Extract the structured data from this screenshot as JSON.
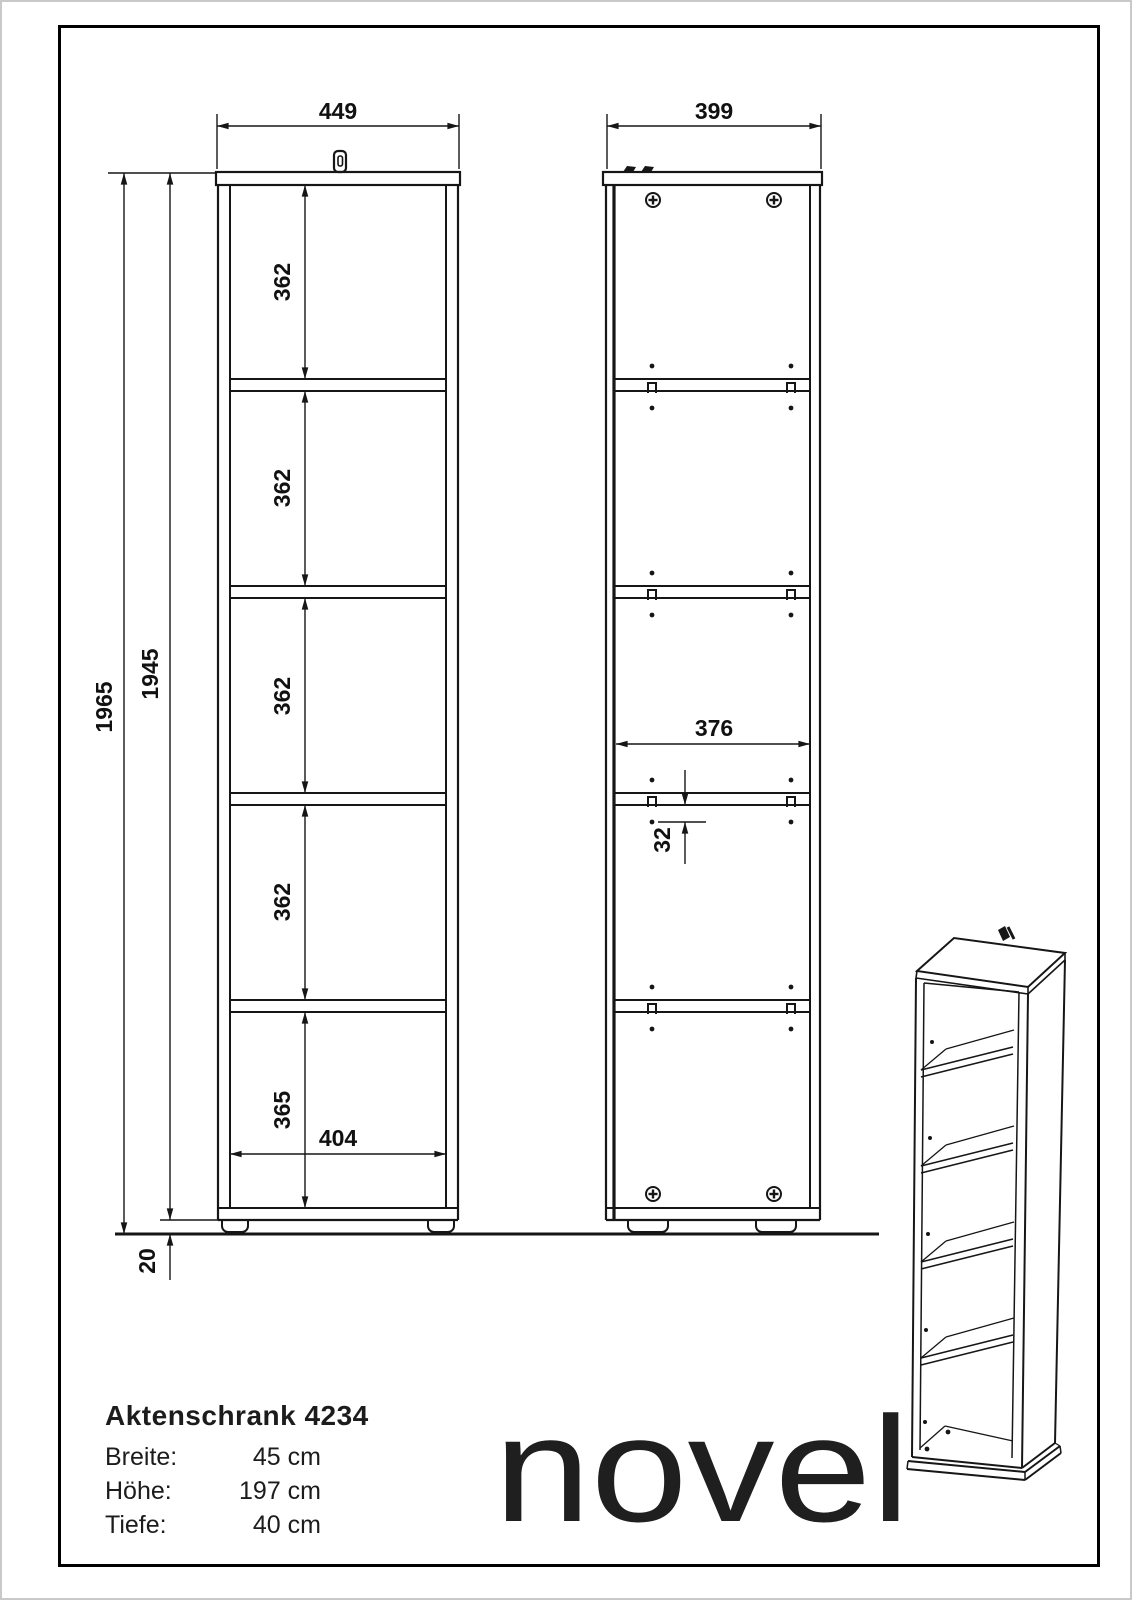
{
  "front_view": {
    "width": "449",
    "inner_width": "404",
    "total_height": "1965",
    "carcass_height": "1945",
    "base_height": "20",
    "compartments": [
      "362",
      "362",
      "362",
      "362",
      "365"
    ]
  },
  "side_view": {
    "depth": "399",
    "inner_width": "376",
    "row_spacing": "32"
  },
  "product": {
    "title": "Aktenschrank 4234",
    "specs": [
      {
        "label": "Breite:",
        "value": "45 cm"
      },
      {
        "label": "Höhe:",
        "value": "197 cm"
      },
      {
        "label": "Tiefe:",
        "value": "40 cm"
      }
    ],
    "brand": "novel"
  }
}
